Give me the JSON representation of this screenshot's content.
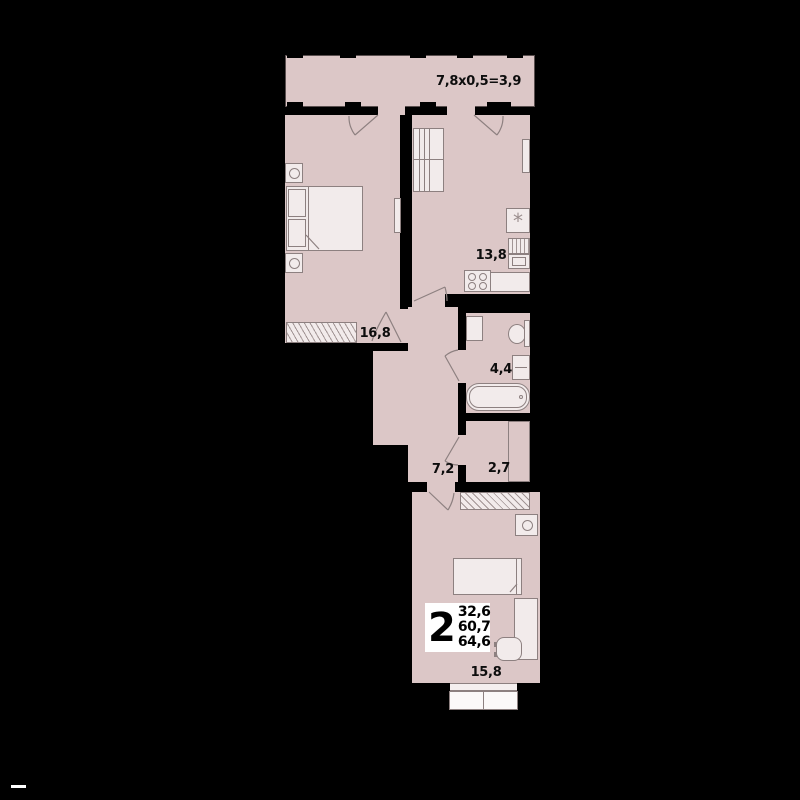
{
  "rooms": {
    "balcony": {
      "dimensions_label": "7,8x0,5=3,9"
    },
    "bedroom": {
      "area": "16,8"
    },
    "kitchen": {
      "area": "13,8"
    },
    "bathroom": {
      "area": "4,4"
    },
    "hallway": {
      "area": "7,2"
    },
    "storage": {
      "area": "2,7"
    },
    "living_room": {
      "area": "15,8"
    }
  },
  "apartment_badge": {
    "room_count": "2",
    "living_area": "32,6",
    "total_area": "60,7",
    "total_area_with_balcony": "64,6"
  },
  "icons": {
    "fridge_snowflake": "*"
  },
  "colors": {
    "background": "#000000",
    "room_fill": "#dcc7c7",
    "furniture_fill": "#f2ebeb",
    "outline": "#8d8080",
    "wall": "#000000",
    "label_color": "#0d0d0d",
    "badge_bg": "#ffffff"
  }
}
